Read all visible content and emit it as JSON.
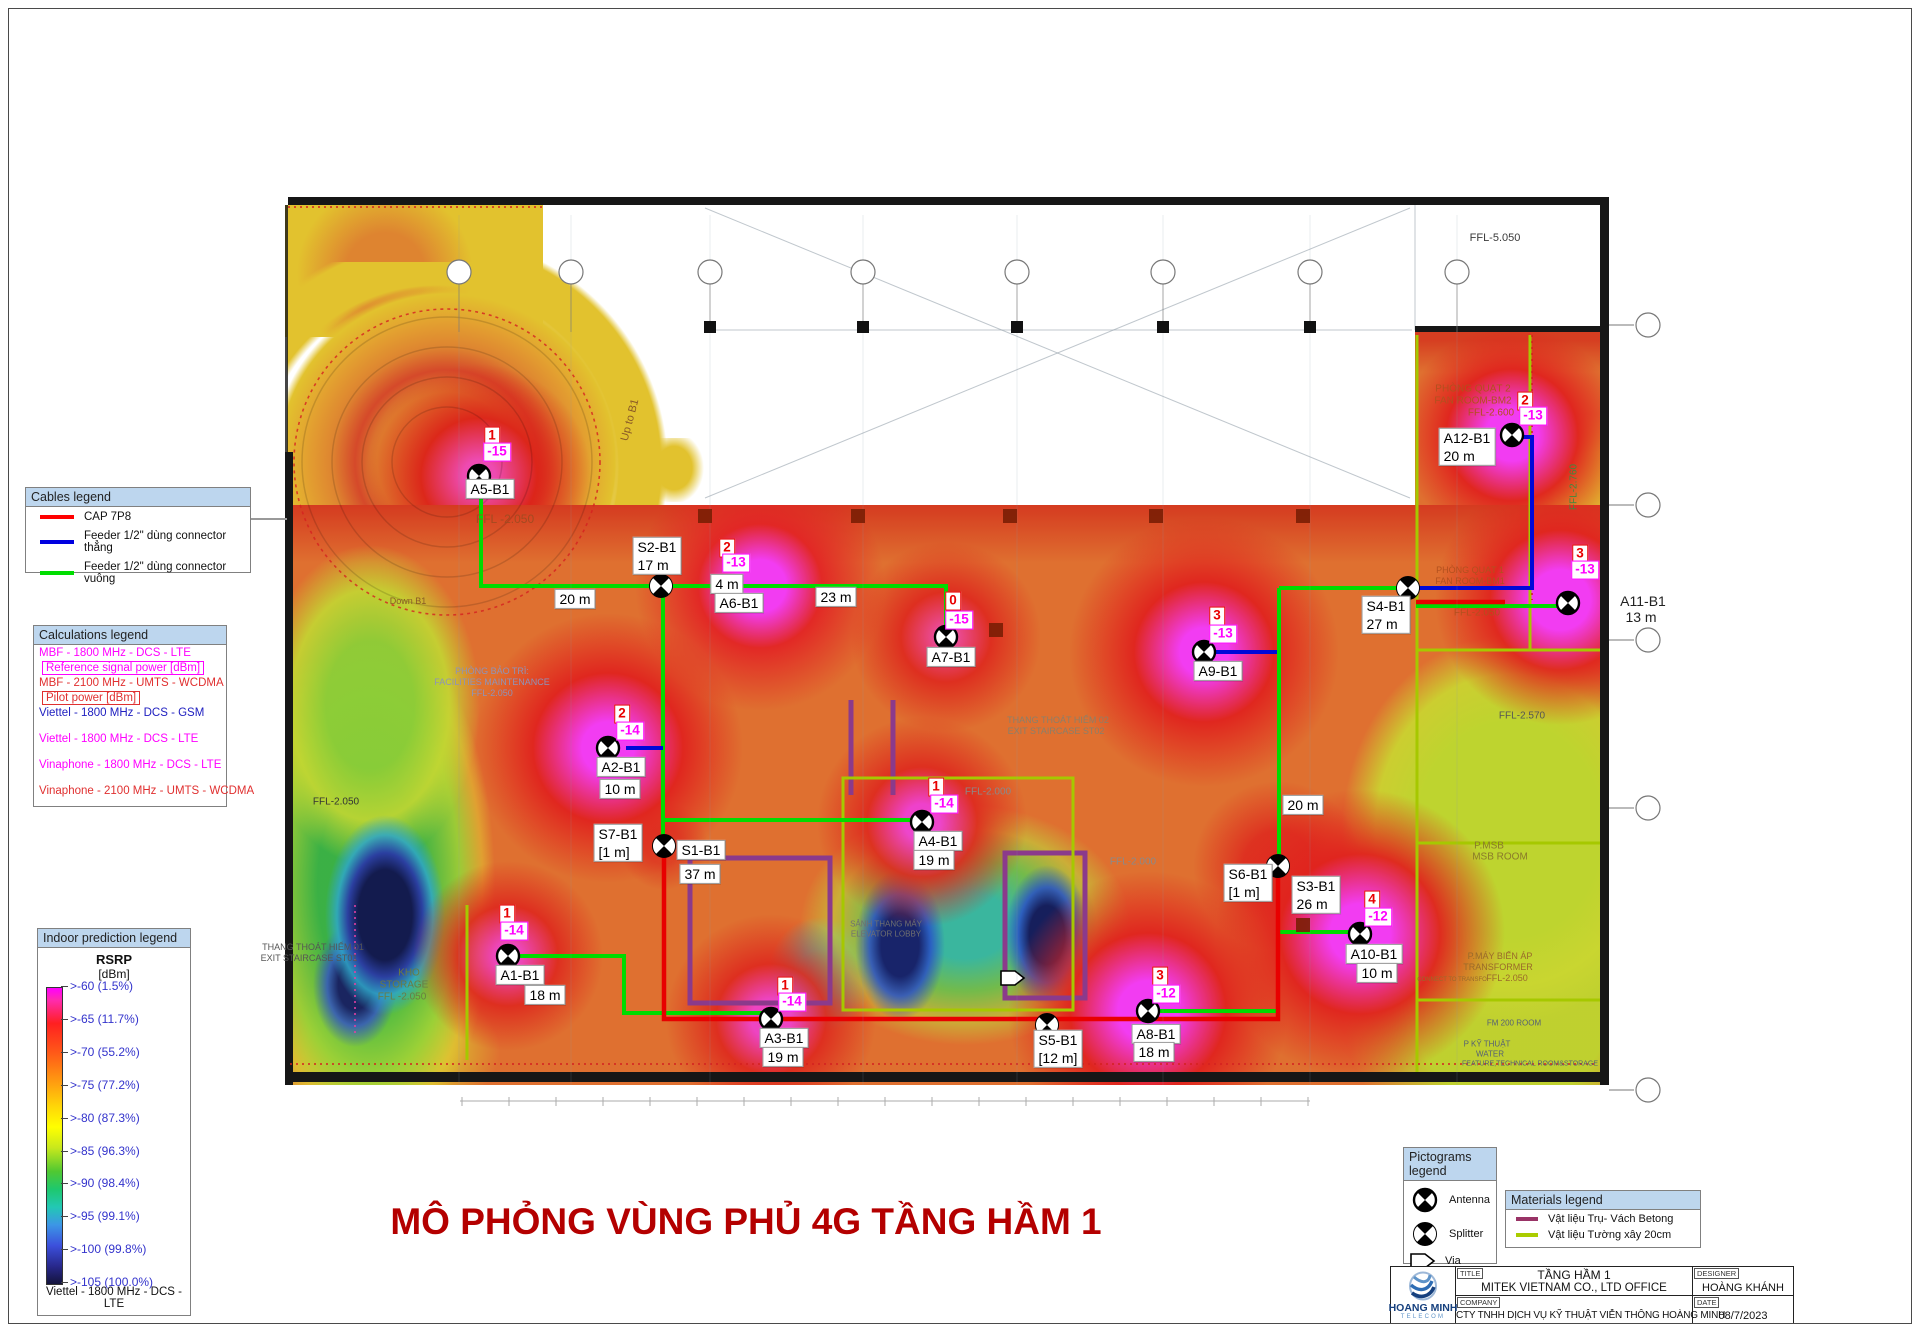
{
  "page": {
    "title_text": "MÔ PHỎNG VÙNG PHỦ 4G TẦNG HẦM 1",
    "title_color": "#B40000"
  },
  "cables_legend": {
    "header": "Cables legend",
    "items": [
      {
        "color": "#FF0000",
        "label": "CAP 7P8"
      },
      {
        "color": "#0000E0",
        "label": "Feeder 1/2\" dùng connector thẳng"
      },
      {
        "color": "#00DD00",
        "label": "Feeder 1/2\" dùng connector vuông"
      }
    ]
  },
  "calculations_legend": {
    "header": "Calculations legend",
    "items": [
      {
        "label": "MBF - 1800 MHz - DCS - LTE",
        "color": "#FF00FF",
        "boxed": false,
        "gap": false
      },
      {
        "label": "Reference signal power [dBm]",
        "color": "#FF00FF",
        "boxed": true,
        "gap": false
      },
      {
        "label": "MBF - 2100 MHz - UMTS - WCDMA",
        "color": "#E03030",
        "boxed": false,
        "gap": false
      },
      {
        "label": "Pilot power [dBm]",
        "color": "#E03030",
        "boxed": true,
        "gap": false
      },
      {
        "label": "Viettel - 1800 MHz - DCS - GSM",
        "color": "#2020C0",
        "boxed": false,
        "gap": false
      },
      {
        "label": "Viettel - 1800 MHz - DCS - LTE",
        "color": "#FF00FF",
        "boxed": false,
        "gap": true
      },
      {
        "label": "Vinaphone - 1800 MHz - DCS - LTE",
        "color": "#FF00FF",
        "boxed": false,
        "gap": true
      },
      {
        "label": "Vinaphone - 2100 MHz - UMTS - WCDMA",
        "color": "#E03030",
        "boxed": false,
        "gap": true
      }
    ]
  },
  "prediction_legend": {
    "header": "Indoor prediction legend",
    "metric": "RSRP",
    "unit": "[dBm]",
    "scale": [
      ">-60 (1.5%)",
      ">-65 (11.7%)",
      ">-70 (55.2%)",
      ">-75 (77.2%)",
      ">-80 (87.3%)",
      ">-85 (96.3%)",
      ">-90 (98.4%)",
      ">-95 (99.1%)",
      ">-100 (99.8%)",
      ">-105 (100.0%)"
    ],
    "footer": "Viettel - 1800 MHz - DCS - LTE"
  },
  "pictograms_legend": {
    "header": "Pictograms legend",
    "items": [
      {
        "icon": "antenna",
        "label": "Antenna"
      },
      {
        "icon": "splitter",
        "label": "Splitter"
      },
      {
        "icon": "via",
        "label": "Via"
      }
    ]
  },
  "materials_legend": {
    "header": "Materials legend",
    "items": [
      {
        "color": "#993366",
        "label": "Vật liệu Trụ- Vách Betong"
      },
      {
        "color": "#AACC00",
        "label": "Vật liệu Tường xây 20cm"
      }
    ]
  },
  "title_block": {
    "logo_name": "HOANG MINH",
    "logo_sub": "TELECOM",
    "title_label": "TITLE",
    "title_line1": "TẦNG HẦM 1",
    "title_line2": "MITEK VIETNAM CO., LTD OFFICE",
    "designer_label": "DESIGNER",
    "designer": "HOÀNG KHÁNH",
    "company_label": "COMPANY",
    "company": "CTY TNHH DỊCH VỤ KỸ THUẬT VIỄN THÔNG HOÀNG MINH",
    "date_label": "DATE",
    "date": "08/7/2023"
  },
  "map": {
    "devices": [
      {
        "id": "A5-B1",
        "icon": "antenna",
        "x": 479,
        "y": 476,
        "num": {
          "t": "1",
          "x": 492,
          "y": 436
        },
        "val": {
          "t": "-15",
          "x": 497,
          "y": 452
        },
        "labels": [
          {
            "lines": [
              "A5-B1"
            ],
            "x": 490,
            "y": 489
          }
        ]
      },
      {
        "id": "S2-B1",
        "icon": "splitter",
        "x": 661,
        "y": 586,
        "labels": [
          {
            "lines": [
              "S2-B1",
              "17 m"
            ],
            "x": 657,
            "y": 556
          }
        ]
      },
      {
        "id": "A6-B1",
        "icon": null,
        "num": {
          "t": "2",
          "x": 727,
          "y": 548
        },
        "val": {
          "t": "-13",
          "x": 736,
          "y": 563
        },
        "labels": [
          {
            "lines": [
              "4 m"
            ],
            "x": 727,
            "y": 584
          },
          {
            "lines": [
              "A6-B1"
            ],
            "x": 739,
            "y": 603
          }
        ]
      },
      {
        "id": "A7-B1",
        "icon": "antenna",
        "x": 946,
        "y": 637,
        "num": {
          "t": "0",
          "x": 953,
          "y": 601
        },
        "val": {
          "t": "-15",
          "x": 959,
          "y": 620
        },
        "labels": [
          {
            "lines": [
              "A7-B1"
            ],
            "x": 951,
            "y": 657
          }
        ]
      },
      {
        "id": "A9-B1",
        "icon": "antenna",
        "x": 1204,
        "y": 652,
        "num": {
          "t": "3",
          "x": 1217,
          "y": 616
        },
        "val": {
          "t": "-13",
          "x": 1223,
          "y": 634
        },
        "labels": [
          {
            "lines": [
              "A9-B1"
            ],
            "x": 1218,
            "y": 671
          }
        ]
      },
      {
        "id": "S4-B1",
        "icon": "splitter",
        "x": 1408,
        "y": 588,
        "labels": [
          {
            "lines": [
              "S4-B1",
              "27 m"
            ],
            "x": 1386,
            "y": 615
          }
        ]
      },
      {
        "id": "A12-B1",
        "icon": "antenna",
        "x": 1512,
        "y": 435,
        "num": {
          "t": "2",
          "x": 1525,
          "y": 401
        },
        "val": {
          "t": "-13",
          "x": 1533,
          "y": 416
        },
        "labels": [
          {
            "lines": [
              "A12-B1",
              "20 m"
            ],
            "x": 1467,
            "y": 447
          }
        ]
      },
      {
        "id": "A11-B1",
        "icon": "antenna",
        "x": 1568,
        "y": 603,
        "num": {
          "t": "3",
          "x": 1580,
          "y": 554
        },
        "val": {
          "t": "-13",
          "x": 1585,
          "y": 570
        },
        "labels": []
      },
      {
        "id": "A2-B1",
        "icon": "antenna",
        "x": 608,
        "y": 748,
        "num": {
          "t": "2",
          "x": 622,
          "y": 714
        },
        "val": {
          "t": "-14",
          "x": 630,
          "y": 731
        },
        "labels": [
          {
            "lines": [
              "A2-B1"
            ],
            "x": 621,
            "y": 767
          },
          {
            "lines": [
              "10 m"
            ],
            "x": 620,
            "y": 789
          }
        ]
      },
      {
        "id": "S1-B1",
        "icon": "splitter",
        "x": 664,
        "y": 846,
        "labels": [
          {
            "lines": [
              "S7-B1",
              "[1 m]"
            ],
            "x": 618,
            "y": 843
          },
          {
            "lines": [
              "S1-B1"
            ],
            "x": 701,
            "y": 850
          },
          {
            "lines": [
              "37 m"
            ],
            "x": 700,
            "y": 874
          }
        ]
      },
      {
        "id": "A4-B1",
        "icon": "antenna",
        "x": 922,
        "y": 822,
        "num": {
          "t": "1",
          "x": 936,
          "y": 787
        },
        "val": {
          "t": "-14",
          "x": 944,
          "y": 804
        },
        "labels": [
          {
            "lines": [
              "A4-B1"
            ],
            "x": 938,
            "y": 841
          },
          {
            "lines": [
              "19 m"
            ],
            "x": 934,
            "y": 860
          }
        ]
      },
      {
        "id": "A1-B1",
        "icon": "antenna",
        "x": 508,
        "y": 956,
        "num": {
          "t": "1",
          "x": 507,
          "y": 914
        },
        "val": {
          "t": "-14",
          "x": 514,
          "y": 931
        },
        "labels": [
          {
            "lines": [
              "A1-B1"
            ],
            "x": 520,
            "y": 975
          },
          {
            "lines": [
              "18 m"
            ],
            "x": 545,
            "y": 995
          }
        ]
      },
      {
        "id": "A3-B1",
        "icon": "antenna",
        "x": 771,
        "y": 1019,
        "num": {
          "t": "1",
          "x": 785,
          "y": 986
        },
        "val": {
          "t": "-14",
          "x": 792,
          "y": 1002
        },
        "labels": [
          {
            "lines": [
              "A3-B1"
            ],
            "x": 784,
            "y": 1038
          },
          {
            "lines": [
              "19 m"
            ],
            "x": 783,
            "y": 1057
          }
        ]
      },
      {
        "id": "S5-B1",
        "icon": "splitter",
        "x": 1047,
        "y": 1025,
        "labels": [
          {
            "lines": [
              "S5-B1",
              "[12 m]"
            ],
            "x": 1058,
            "y": 1049
          }
        ]
      },
      {
        "id": "A8-B1",
        "icon": "antenna",
        "x": 1148,
        "y": 1011,
        "num": {
          "t": "3",
          "x": 1160,
          "y": 976
        },
        "val": {
          "t": "-12",
          "x": 1166,
          "y": 994
        },
        "labels": [
          {
            "lines": [
              "A8-B1"
            ],
            "x": 1156,
            "y": 1034
          },
          {
            "lines": [
              "18 m"
            ],
            "x": 1154,
            "y": 1052
          }
        ]
      },
      {
        "id": "S6-B1",
        "icon": "splitter",
        "x": 1278,
        "y": 866,
        "labels": [
          {
            "lines": [
              "S6-B1",
              "[1 m]"
            ],
            "x": 1248,
            "y": 883
          }
        ]
      },
      {
        "id": "S3-B1",
        "icon": null,
        "labels": [
          {
            "lines": [
              "S3-B1",
              "26 m"
            ],
            "x": 1316,
            "y": 895
          }
        ]
      },
      {
        "id": "A10-B1",
        "icon": "antenna",
        "x": 1360,
        "y": 934,
        "num": {
          "t": "4",
          "x": 1372,
          "y": 900
        },
        "val": {
          "t": "-12",
          "x": 1378,
          "y": 917
        },
        "labels": [
          {
            "lines": [
              "A10-B1"
            ],
            "x": 1374,
            "y": 954
          },
          {
            "lines": [
              "10 m"
            ],
            "x": 1377,
            "y": 973
          }
        ]
      }
    ],
    "free_labels": [
      {
        "text": "20 m",
        "x": 575,
        "y": 599,
        "boxed": true
      },
      {
        "text": "23 m",
        "x": 836,
        "y": 597,
        "boxed": true
      },
      {
        "text": "20 m",
        "x": 1303,
        "y": 805,
        "boxed": true
      },
      {
        "text": "A11-B1",
        "x": 1643,
        "y": 601,
        "boxed": false
      },
      {
        "text": "13 m",
        "x": 1641,
        "y": 617,
        "boxed": false
      }
    ],
    "plan_texts": [
      {
        "t": "FFL-5.050",
        "x": 1495,
        "y": 238,
        "c": "#3a3a3a",
        "s": 11
      },
      {
        "t": "FFL -2.050",
        "x": 505,
        "y": 519,
        "c": "#A34A20",
        "s": 12
      },
      {
        "t": "Up to B1",
        "x": 630,
        "y": 420,
        "c": "#8a5a26",
        "s": 11,
        "r": -75
      },
      {
        "t": "Down B1",
        "x": 408,
        "y": 601,
        "c": "#8a5a26",
        "s": 9
      },
      {
        "t": "PHÒNG BẢO TRÌ:",
        "x": 492,
        "y": 671,
        "c": "#8f93b8",
        "s": 9
      },
      {
        "t": "FACILITIES MAINTENANCE",
        "x": 492,
        "y": 682,
        "c": "#8f93b8",
        "s": 9
      },
      {
        "t": "FFL-2.050",
        "x": 492,
        "y": 693,
        "c": "#8f93b8",
        "s": 9
      },
      {
        "t": "FFL-2.050",
        "x": 336,
        "y": 802,
        "c": "#333333",
        "s": 10
      },
      {
        "t": "THANG THOÁT HIỂM 01",
        "x": 313,
        "y": 947,
        "c": "#555555",
        "s": 9
      },
      {
        "t": "EXIT STAIRCASE ST01",
        "x": 309,
        "y": 958,
        "c": "#555555",
        "s": 9
      },
      {
        "t": "KHO",
        "x": 409,
        "y": 973,
        "c": "#6b7c42",
        "s": 10
      },
      {
        "t": "STORAGE",
        "x": 404,
        "y": 985,
        "c": "#6b7c42",
        "s": 10
      },
      {
        "t": "FFL -2.050",
        "x": 402,
        "y": 997,
        "c": "#6b7c42",
        "s": 10
      },
      {
        "t": "THANG THOÁT HIỂM 02",
        "x": 1058,
        "y": 720,
        "c": "#8a7f6a",
        "s": 9
      },
      {
        "t": "EXIT STAIRCASE ST02",
        "x": 1056,
        "y": 731,
        "c": "#8a7f6a",
        "s": 9
      },
      {
        "t": "FFL-2.000",
        "x": 1133,
        "y": 862,
        "c": "#8a8a8a",
        "s": 10
      },
      {
        "t": "FFL-2.000",
        "x": 988,
        "y": 792,
        "c": "#8a8a8a",
        "s": 10
      },
      {
        "t": "SẢNH THANG MÁY",
        "x": 886,
        "y": 924,
        "c": "#707070",
        "s": 8
      },
      {
        "t": "ELEVATOR LOBBY",
        "x": 886,
        "y": 934,
        "c": "#707070",
        "s": 8
      },
      {
        "t": "PHÒNG QUẠT 2",
        "x": 1473,
        "y": 389,
        "c": "#B2501E",
        "s": 10
      },
      {
        "t": "FAN ROOM-BM2",
        "x": 1473,
        "y": 401,
        "c": "#B2501E",
        "s": 10
      },
      {
        "t": "FFL-2.600",
        "x": 1491,
        "y": 413,
        "c": "#B2501E",
        "s": 10
      },
      {
        "t": "PHÒNG QUẠT 1",
        "x": 1470,
        "y": 570,
        "c": "#B2501E",
        "s": 9
      },
      {
        "t": "FAN ROOM-BM1",
        "x": 1470,
        "y": 581,
        "c": "#B2501E",
        "s": 9
      },
      {
        "t": "FFL-2.050",
        "x": 1477,
        "y": 613,
        "c": "#B2501E",
        "s": 10
      },
      {
        "t": "FFL-2.570",
        "x": 1522,
        "y": 716,
        "c": "#555555",
        "s": 10
      },
      {
        "t": "P.MSB",
        "x": 1489,
        "y": 846,
        "c": "#8a7a2a",
        "s": 10
      },
      {
        "t": "MSB ROOM",
        "x": 1500,
        "y": 857,
        "c": "#8a7a2a",
        "s": 10
      },
      {
        "t": "P.MÁY BIẾN ÁP",
        "x": 1500,
        "y": 956,
        "c": "#9a6a2a",
        "s": 9
      },
      {
        "t": "TRANSFORMER",
        "x": 1498,
        "y": 967,
        "c": "#9a6a2a",
        "s": 9
      },
      {
        "t": "FFL-2.050",
        "x": 1507,
        "y": 978,
        "c": "#9a6a2a",
        "s": 9
      },
      {
        "t": "CONNECT TO TRANSFO",
        "x": 1452,
        "y": 980,
        "c": "#9a6a2a",
        "s": 6
      },
      {
        "t": "FM 200 ROOM",
        "x": 1514,
        "y": 1023,
        "c": "#556074",
        "s": 8
      },
      {
        "t": "P KỸ THUẬT",
        "x": 1487,
        "y": 1044,
        "c": "#556074",
        "s": 8
      },
      {
        "t": "WATER",
        "x": 1490,
        "y": 1054,
        "c": "#556074",
        "s": 8
      },
      {
        "t": "FEATURE,TECHNICAL ROOM&STORAGE",
        "x": 1530,
        "y": 1064,
        "c": "#556074",
        "s": 7
      },
      {
        "t": "FFL-2.760",
        "x": 1574,
        "y": 487,
        "c": "#3E8A3E",
        "s": 10,
        "r": -90
      }
    ],
    "cables": [
      {
        "color": "#00DB00",
        "pts": "481,478 481,586 946,586 946,630"
      },
      {
        "color": "#00DB00",
        "pts": "663,586 663,846"
      },
      {
        "color": "#00DB00",
        "pts": "663,820 913,820"
      },
      {
        "color": "#00DB00",
        "pts": "516,956 624,956 624,1013 762,1013"
      },
      {
        "color": "#00DB00",
        "pts": "1157,1011 1277,1011"
      },
      {
        "color": "#00DB00",
        "pts": "1279,588 1279,858"
      },
      {
        "color": "#00DB00",
        "pts": "1279,588 1400,588"
      },
      {
        "color": "#00DB00",
        "pts": "1279,932 1352,932"
      },
      {
        "color": "#00DB00",
        "pts": "1416,606 1560,606"
      },
      {
        "color": "#0008D8",
        "pts": "626,748 663,748"
      },
      {
        "color": "#0008D8",
        "pts": "1216,652 1277,652"
      },
      {
        "color": "#0008D8",
        "pts": "1518,437 1532,437 1532,588 1412,588"
      },
      {
        "color": "#E80000",
        "pts": "664,852 664,1019 1278,1019 1278,872"
      },
      {
        "color": "#E80000",
        "pts": "1416,602 1505,602"
      }
    ]
  }
}
